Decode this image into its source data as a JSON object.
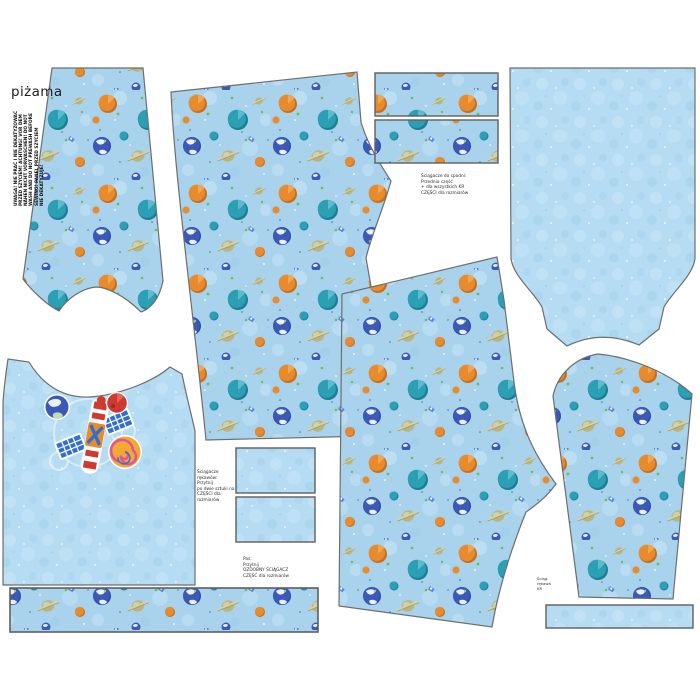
{
  "panel": {
    "title": "piżama",
    "description": "children pajama sewing pattern panel printed on space fabric",
    "pieces": [
      {
        "name": "sleeve-top-left",
        "print": "planets"
      },
      {
        "name": "pants-front",
        "print": "planets"
      },
      {
        "name": "cuff-strip-1",
        "print": "planets"
      },
      {
        "name": "cuff-strip-2",
        "print": "planets"
      },
      {
        "name": "top-back",
        "print": "plain"
      },
      {
        "name": "tank-front-with-motif",
        "print": "plain"
      },
      {
        "name": "hem-band",
        "print": "planets"
      },
      {
        "name": "pants-back",
        "print": "planets"
      },
      {
        "name": "pocket-rect-1",
        "print": "plain"
      },
      {
        "name": "pocket-rect-2",
        "print": "plain"
      },
      {
        "name": "sleeve-bottom-right",
        "print": "planets"
      },
      {
        "name": "cuff-strip-plain",
        "print": "plain"
      }
    ]
  },
  "fabric": {
    "base_color": "#a9d3ec",
    "mottle_color": "#c9e6f7",
    "plain_color": "#b5dcf3",
    "planet_orange": "#e98b2d",
    "planet_orange_dark": "#c8701e",
    "planet_teal": "#2b9fb4",
    "planet_teal_dark": "#1d7f93",
    "earth_blue": "#3c59b8",
    "continent_white": "#e9f2fb",
    "saturn_olive": "#b9b583",
    "saturn_ring": "#d8d2a2",
    "accent_green": "#67c14f",
    "rocket_blue": "#5b86d8",
    "outline_gray": "#6e6e6e"
  },
  "motif": {
    "name": "satellite with planets",
    "satellite_red": "#cf3a30",
    "panel_blue": "#2f6fd0",
    "spiral_planet_yellow": "#f3aa33",
    "spiral_pink": "#e0559a",
    "mars_red": "#cf3a30"
  },
  "care": {
    "lines": [
      "UWAGA! NIE PRAĆ I NIE DEKATYZOWAĆ",
      "PRZED SZYCIEM! ACHTUNG! VOR DEM",
      "NÄHEN NICHT VORWASCHEN! DO NOT",
      "WASH AND DO NOT PREWASH BEFORE",
      "SEWING! PANEL PRZED SZYCIEM",
      "NIE DEKATYZUJE!"
    ]
  },
  "notes": {
    "note1": {
      "lines": [
        "Ściągacze do spodni:",
        "Przednia część",
        "+ dla wszystkich KR",
        "CZĘŚCI dla rozmiarów"
      ]
    },
    "note2": {
      "lines": [
        "Ściągacze rękawów:",
        "Przytnij",
        "po dwie sztuki na",
        "CZĘŚCI dla rozmiarów"
      ]
    },
    "note3": {
      "lines": [
        "Pas:",
        "Przytnij",
        "OZDOBNY ŚCIĄGACZ",
        "CZĘŚĆ dla rozmiarów"
      ]
    },
    "note4": {
      "lines": [
        "Ściąg.",
        "rękawa",
        "KR"
      ]
    }
  }
}
